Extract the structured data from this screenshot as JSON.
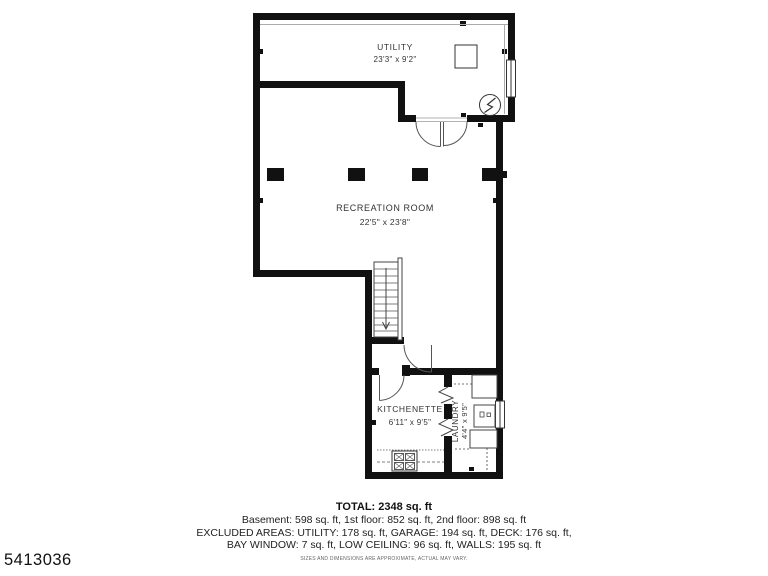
{
  "plan_id": "5413036",
  "rooms": {
    "utility": {
      "name": "UTILITY",
      "dims": "23'3\" x 9'2\""
    },
    "recreation": {
      "name": "RECREATION ROOM",
      "dims": "22'5\" x 23'8\""
    },
    "kitchenette": {
      "name": "KITCHENETTE",
      "dims": "6'11\" x 9'5\""
    },
    "laundry": {
      "name": "LAUNDRY",
      "dims": "4'4\" x 9'5\""
    }
  },
  "summary": {
    "total": "TOTAL: 2348 sq. ft",
    "floors": "Basement: 598 sq. ft, 1st floor: 852 sq. ft, 2nd floor: 898 sq. ft",
    "excluded_line1": "EXCLUDED AREAS: UTILITY: 178 sq. ft, GARAGE: 194 sq. ft, DECK: 176 sq. ft,",
    "excluded_line2": "BAY WINDOW: 7 sq. ft, LOW CEILING: 96 sq. ft, WALLS: 195 sq. ft",
    "disclaimer": "SIZES AND DIMENSIONS ARE APPROXIMATE, ACTUAL MAY VARY."
  },
  "colors": {
    "wall": "#111111",
    "fixture_line": "#444444",
    "text": "#222222",
    "background": "#ffffff"
  }
}
